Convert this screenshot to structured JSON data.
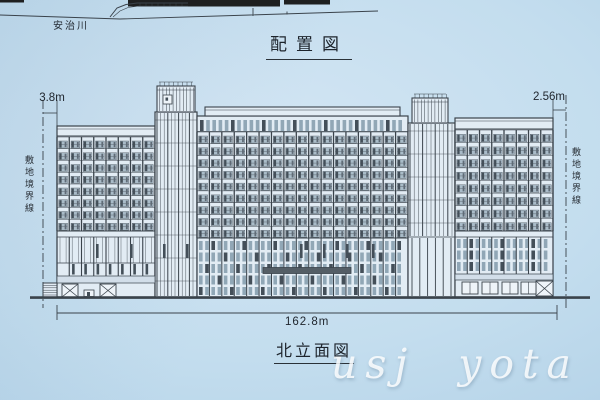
{
  "titles": {
    "site_plan": "配置図",
    "elevation": "北立面図"
  },
  "site_plan": {
    "river_label": "安治川"
  },
  "dimensions": {
    "left_offset": "3.8m",
    "right_offset": "2.56m",
    "total_width": "162.8m"
  },
  "boundary": {
    "left_label": "敷地境界線",
    "right_label": "敷地境界線"
  },
  "watermark": {
    "text": "usj yota"
  },
  "colors": {
    "paper": "#c3ddee",
    "line": "#333b43",
    "line_soft": "#5a6570",
    "fill": "#e4edf5",
    "fill_shade": "#d3dfe9",
    "railing": "#a8bac6",
    "unit_dark": "#3d4851",
    "window_small": "#8ea4b3",
    "band_black": "#161616",
    "canopy": "#4e575f",
    "glass_light": "#f1f6fa"
  },
  "site_strip": {
    "bands": [
      [
        128,
        0,
        152,
        6.5
      ],
      [
        284,
        0,
        46,
        4.5
      ],
      [
        0,
        0,
        24,
        2.5
      ]
    ],
    "shore": [
      [
        0,
        15
      ],
      [
        120,
        19
      ],
      [
        250,
        15
      ],
      [
        378,
        11
      ]
    ],
    "ramp_outer": [
      [
        110,
        17
      ],
      [
        117,
        8
      ],
      [
        126,
        4.5
      ],
      [
        137,
        3
      ],
      [
        188,
        3
      ]
    ],
    "ramp_inner": [
      [
        113,
        17
      ],
      [
        120,
        11
      ],
      [
        128,
        7.5
      ],
      [
        139,
        6
      ],
      [
        188,
        6
      ]
    ],
    "ramp_ticks": [
      140,
      146,
      152,
      158,
      164,
      170,
      176,
      182
    ],
    "ticks": [
      [
        253,
        8,
        253,
        16
      ],
      [
        287,
        11.5,
        287,
        14.5
      ]
    ]
  },
  "elevation": {
    "ground_y": 297,
    "sections": [
      {
        "type": "wing",
        "x": 57,
        "w": 98,
        "roof": 126,
        "band": 136,
        "grid_top": 137,
        "grid_bot": 231,
        "floors": 8,
        "bays": 8
      },
      {
        "type": "core",
        "x": 155,
        "w": 42,
        "roof": 112,
        "stripe": 3.6,
        "pent_x": 157,
        "pent_w": 38,
        "pent_top": 86,
        "box": [
          163,
          95,
          9,
          9
        ]
      },
      {
        "type": "center",
        "x": 197,
        "w": 211,
        "roof": 116,
        "cap_top": 107,
        "toprow_top": 120,
        "toprow_bot": 131,
        "grid_top": 132,
        "grid_bot": 238,
        "floors": 9,
        "bays": 17
      },
      {
        "type": "core",
        "x": 408,
        "w": 47,
        "roof": 123,
        "stripe": 4.2,
        "pent_x": 412,
        "pent_w": 36,
        "pent_top": 98,
        "colonnade_top": 237
      },
      {
        "type": "wing",
        "x": 455,
        "w": 98,
        "roof": 118,
        "band": 129,
        "grid_top": 130,
        "grid_bot": 231,
        "floors": 8,
        "bays": 8
      }
    ],
    "podium": {
      "left": {
        "x": 57,
        "w": 98,
        "top": 231,
        "mid": 237,
        "stripe_bot": 263,
        "pier_bot": 276,
        "band_bot": 283
      },
      "center": {
        "x": 197,
        "w": 211,
        "top": 238,
        "rows": [
          [
            241,
            9
          ],
          [
            252.5,
            9
          ],
          [
            264,
            9
          ],
          [
            275.5,
            9
          ],
          [
            287,
            8
          ]
        ],
        "canopy": [
          263,
          267.5,
          88,
          6
        ]
      },
      "right": {
        "x": 455,
        "w": 98,
        "top": 231,
        "mid": 237,
        "rows": [
          [
            239,
            9
          ],
          [
            250.5,
            9
          ],
          [
            262,
            9
          ]
        ],
        "band_y": 274
      },
      "slits_x": [
        96,
        130,
        163,
        186,
        300,
        323,
        346,
        372
      ]
    },
    "ground": {
      "annex": [
        43,
        283,
        14,
        14.5
      ],
      "xboxes": [
        [
          62,
          284,
          16,
          13
        ],
        [
          100,
          284,
          16,
          13
        ],
        [
          536,
          281,
          17,
          15
        ]
      ],
      "smallbox": [
        84,
        290,
        10,
        6.5
      ],
      "storefronts": [
        [
          462,
          282,
          16,
          12
        ],
        [
          482,
          282,
          16,
          12
        ],
        [
          502,
          282,
          16,
          12
        ],
        [
          521,
          282,
          15,
          12
        ]
      ]
    },
    "dims": {
      "left_bx": 43,
      "left_ex": 57,
      "left_y": 113,
      "right_bx": 566,
      "right_ex": 553,
      "right_y": 110,
      "total_x1": 57,
      "total_x2": 557,
      "total_y": 313
    },
    "boundaries": {
      "left_x": 43,
      "right_x": 566,
      "top_l": 100,
      "top_r": 95,
      "bot": 308
    }
  }
}
